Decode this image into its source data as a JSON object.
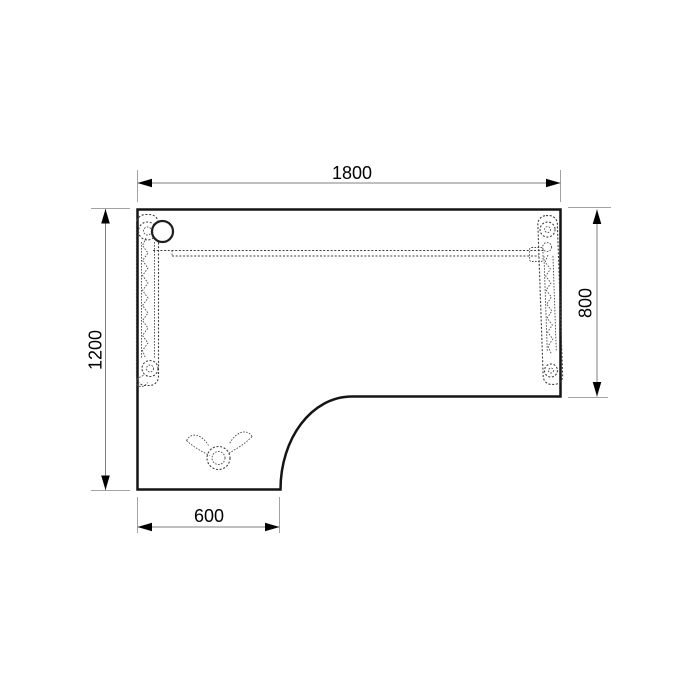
{
  "drawing": {
    "dimensions": {
      "top": {
        "label": "1800"
      },
      "left": {
        "label": "1200"
      },
      "right": {
        "label": "800"
      },
      "bottom": {
        "label": "600"
      }
    },
    "icons": {
      "grommet": "cable-grommet-icon",
      "left_leg": "lifting-column-left-icon",
      "right_leg": "lifting-column-right-icon",
      "crossbar": "cable-tray-icon",
      "foot": "caster-foot-icon"
    },
    "colors": {
      "background": "#ffffff",
      "outline": "#141414",
      "hidden_lines": "#3d3d3d",
      "dimension_lines": "#7f7f7f",
      "extension_lines": "#a3a3a3",
      "arrowheads": "#000000",
      "labels": "#000000"
    }
  }
}
